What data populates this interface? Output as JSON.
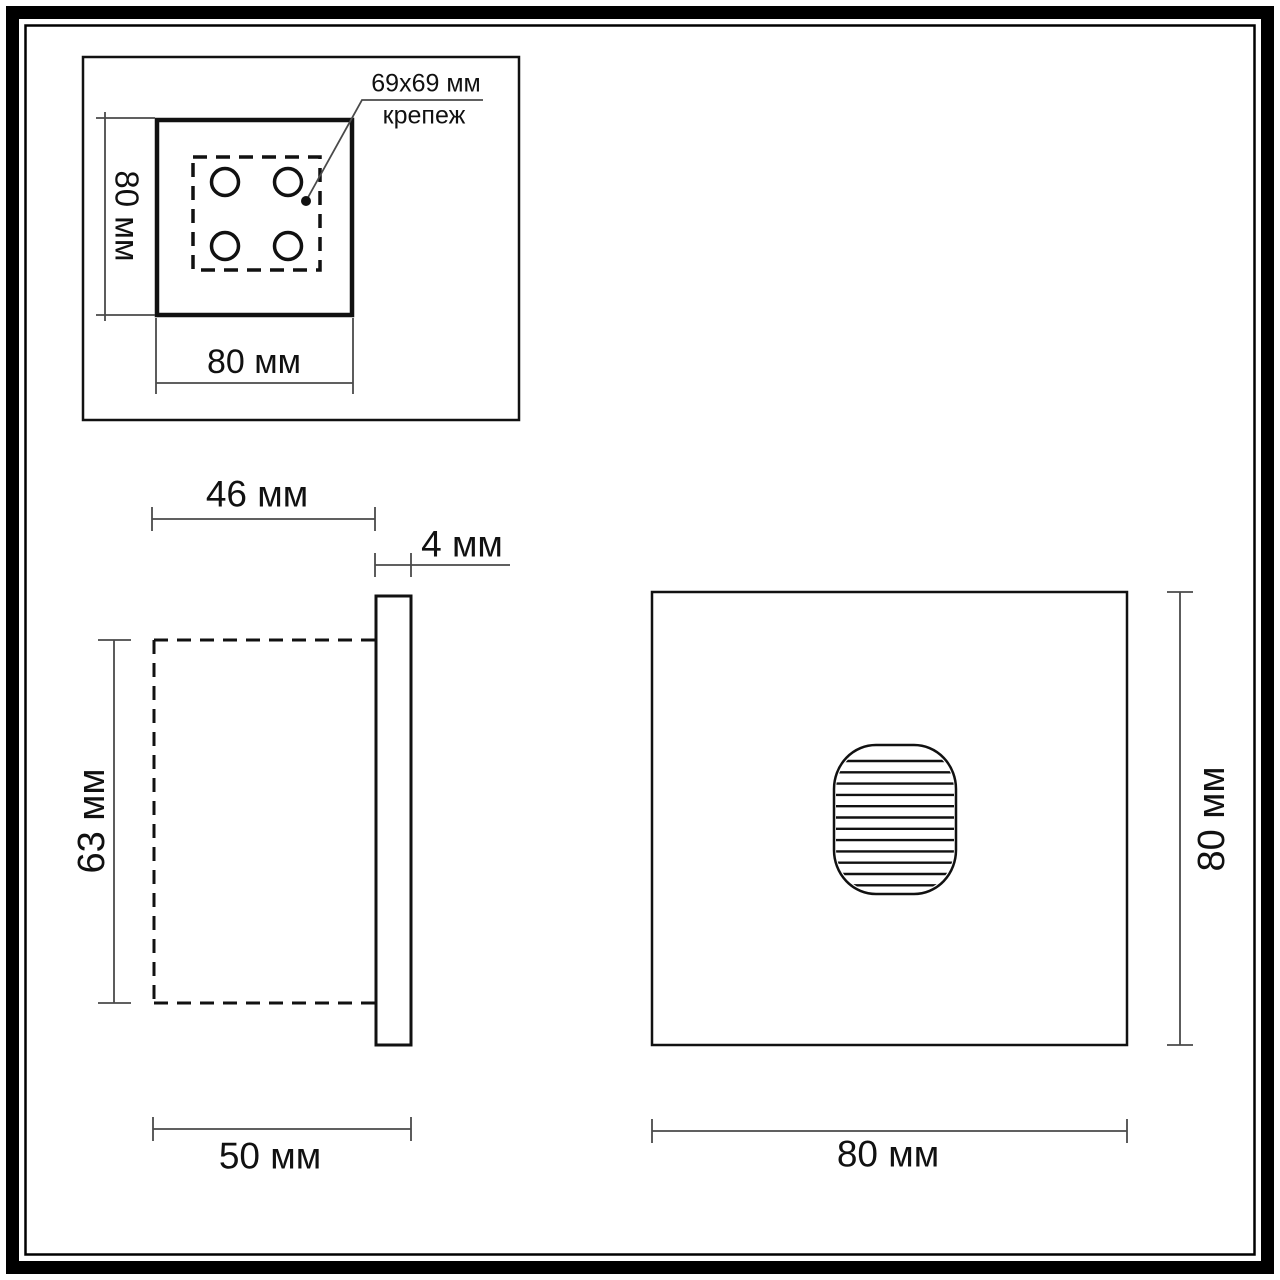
{
  "drawing": {
    "type": "technical-dimension-drawing",
    "units": "мм",
    "colors": {
      "background": "#ffffff",
      "object_line": "#111111",
      "dimension_line": "#4a4a4a",
      "text": "#111111"
    },
    "top_view": {
      "height_label": "80 мм",
      "width_label": "80 мм",
      "mount_note": {
        "size": "69x69 мм",
        "caption": "крепеж"
      }
    },
    "side_view": {
      "body_depth_label": "46 мм",
      "plate_thickness_label": "4 мм",
      "body_height_label": "63 мм",
      "total_depth_label": "50 мм"
    },
    "front_view": {
      "height_label": "80 мм",
      "width_label": "80 мм"
    }
  }
}
